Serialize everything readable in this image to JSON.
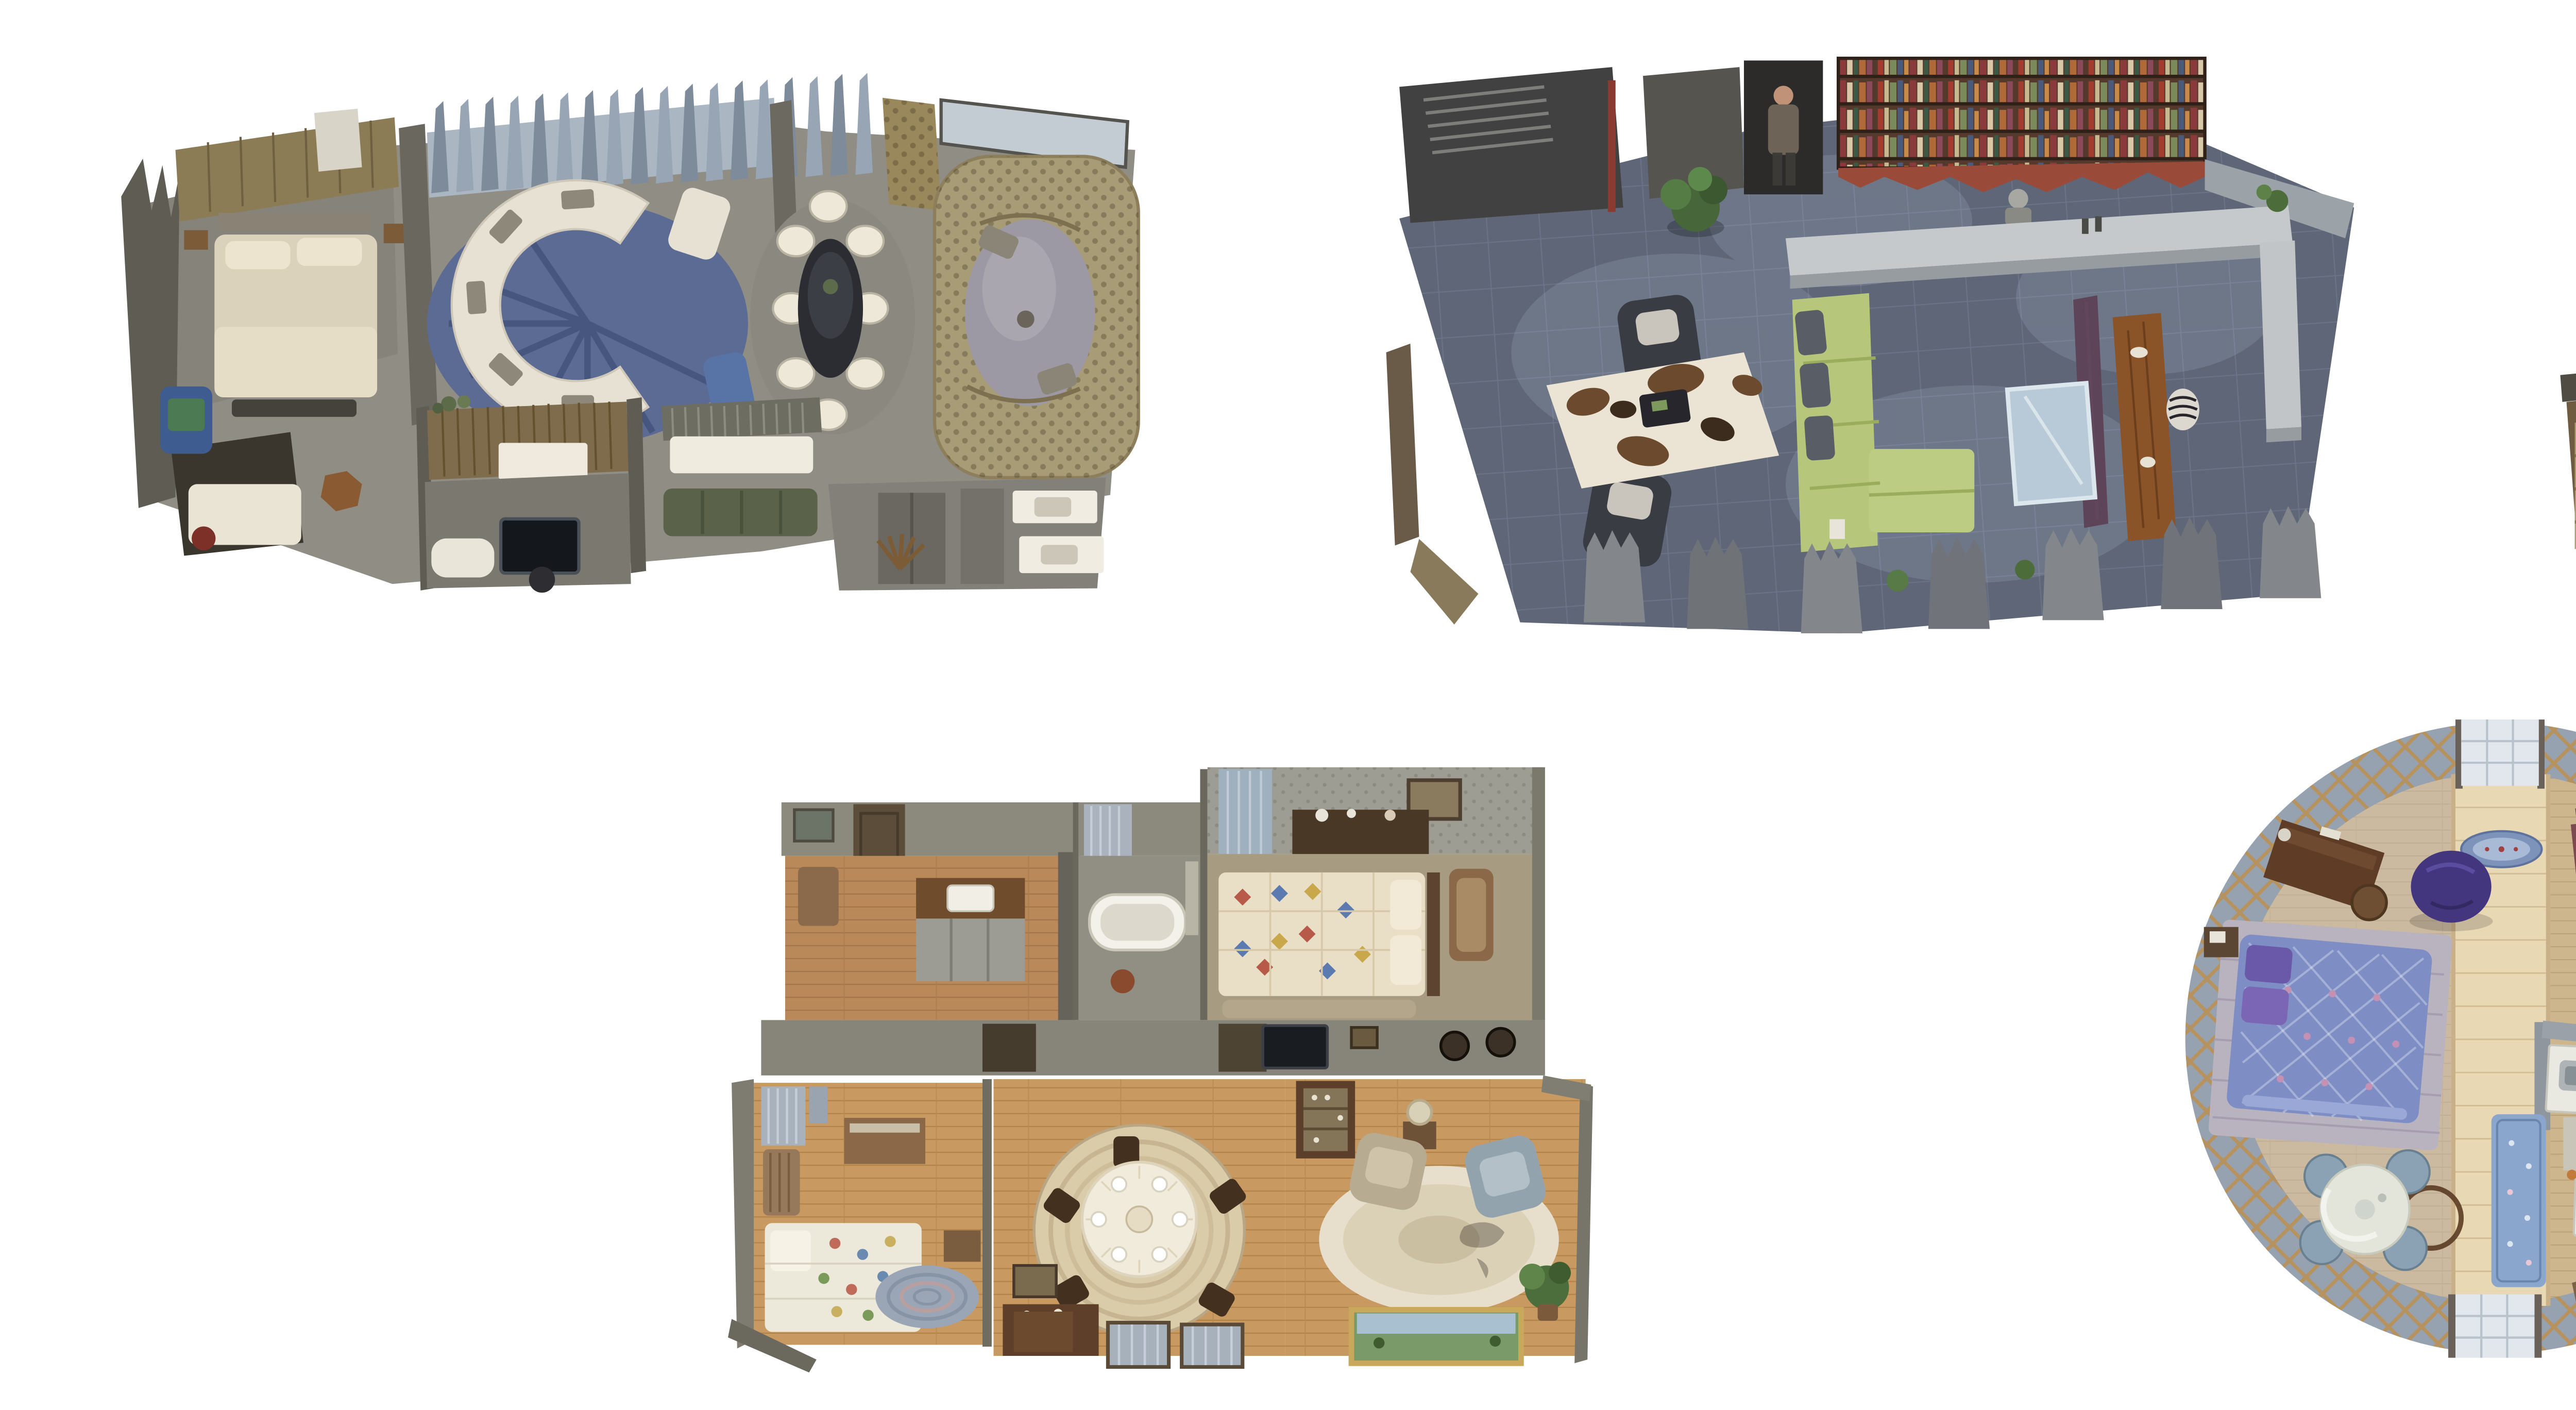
{
  "page": {
    "background": "#ffffff",
    "description": "Five textured 3D dollhouse-view interior scans arranged in two rows on a white canvas"
  },
  "scans": [
    {
      "id": "scan-1",
      "name": "suite-with-curved-sofa-scan",
      "description": "Wide suite: bedroom with cream bed and gold headboard wall, curved white sectional on blue radial rug, oval dining table with eight white chairs, tufted khaki banquette lounge, blue armchair nook, wood-panel alcove with TV, double-sink bathroom",
      "palette": {
        "floor": "#8f8c84",
        "wall": "#6a675f",
        "spikes": "#97a5b5",
        "sofa": "#e7e1d3",
        "rug": "#5c6b93",
        "banquette": "#a89c77",
        "bed": "#dbd2bb"
      }
    },
    {
      "id": "scan-2",
      "name": "loft-with-green-sectional-scan",
      "description": "Open loft: dark slate tile floor, full-width bookshelf wall, standing figure in doorway, lime-green L sectional, long walnut dining table, purple partition, glass floor panel, two leather armchairs, cowhide rug, potted plant",
      "palette": {
        "floor": "#5e6677",
        "books_wall": "#55392c",
        "accent_wall": "#9a4a38",
        "sofa": "#b6c77b",
        "table": "#8a5428",
        "counter": "#c6c9cc"
      }
    },
    {
      "id": "scan-3",
      "name": "open-plan-kitchen-living-scan",
      "description": "L-shaped open plan: oak floors, straight staircase, gray kitchen with island and four stools, TV on plank wall, white sectional around striped rug with round ottoman, dining table set with upholstered chairs, dark side hallway, garden-view windows",
      "palette": {
        "floor": "#d7bf98",
        "stairs": "#c9b286",
        "rug": "#9ba8b6",
        "sofa": "#e8e2d3",
        "island": "#d3bd95"
      }
    },
    {
      "id": "scan-4",
      "name": "vintage-apartment-scan",
      "description": "Period apartment: kitchen with farmhouse sink, bathroom with clawfoot tub, two quilt-covered bedrooms, round lace-covered dining table on braided rug, parlor with two armchairs, china cabinet, oval rug and framed landscape painting",
      "palette": {
        "floor": "#c0945c",
        "wall": "#87857a",
        "dining_rug": "#dacba9",
        "quilt": "#ece8da",
        "curtain": "#a7b1bc"
      }
    },
    {
      "id": "scan-5",
      "name": "round-yurt-room-scan",
      "description": "Circular yurt room: lattice walls, plank floor with bright center walkway, purple diamond-quilt double bed, two purple bean bags, writing desk, dresser with mirror, kitchenette with sink and stove, blue floral runner, bathroom nook, round table with four blue chairs",
      "palette": {
        "wall": "#97a2b1",
        "lattice": "#b5925e",
        "floor": "#cdb58e",
        "walkway": "#e8d8b4",
        "quilt": "#7e8ec4",
        "beanbag": "#43367e"
      }
    }
  ]
}
